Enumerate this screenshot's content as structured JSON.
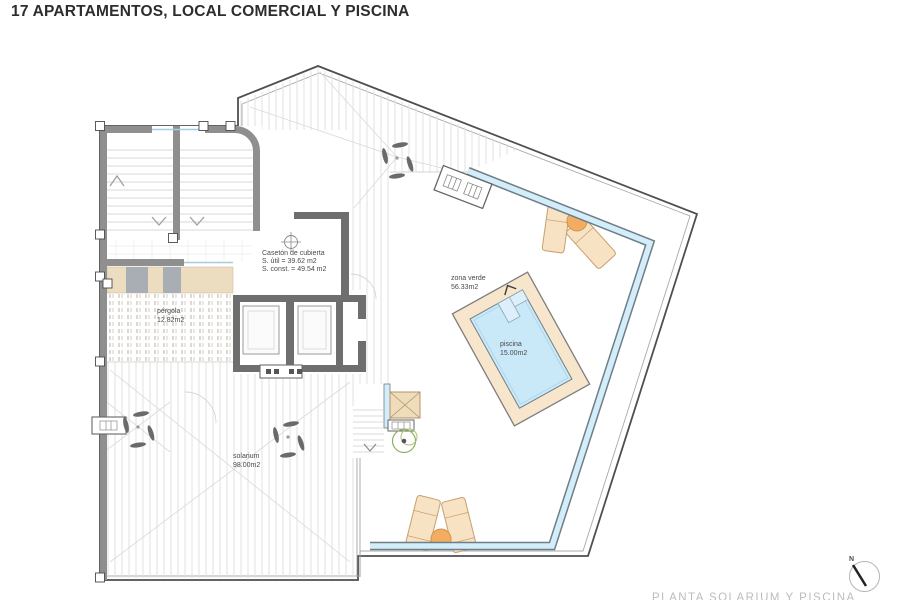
{
  "title": "17 APARTAMENTOS, LOCAL COMERCIAL Y PISCINA",
  "plan": {
    "rooms": {
      "caseton": {
        "name": "Casetón de cubierta",
        "util": "S. útil = 39.62 m2",
        "const": "S. const. = 49.54 m2"
      },
      "zona_verde": {
        "name": "zona verde",
        "area": "56.33m2"
      },
      "piscina": {
        "name": "piscina",
        "area": "15.00m2"
      },
      "solarium": {
        "name": "solarium",
        "area": "98.00m2"
      },
      "pergola": {
        "name": "pérgola",
        "area": "12.82m2"
      }
    },
    "compass": {
      "label": "N"
    },
    "footer_caption": "PLANTA SOLARIUM Y PISCINA",
    "colors": {
      "pool_water": "#c9e8f8",
      "pool_deck": "#f7e6cc",
      "balustrade": "#d3eefa",
      "wall": "#8f8f8f",
      "wall_dark": "#6e6e6e",
      "furniture": "#f7e2c4",
      "table": "#f2ad62",
      "plant": "#8fae5a"
    }
  }
}
